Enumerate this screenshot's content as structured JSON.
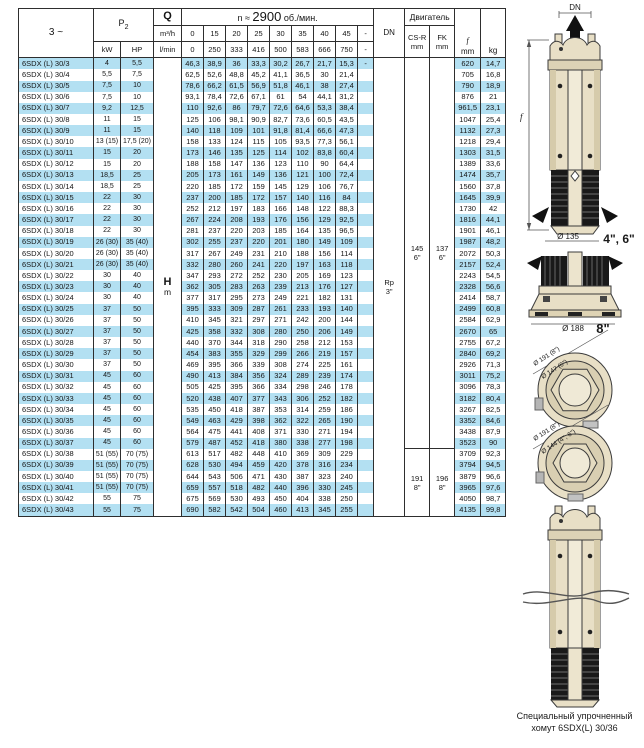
{
  "page": {
    "caption_line1": "Специальный упрочненный",
    "caption_line2": "хомут 6SDX(L) 30/36"
  },
  "table": {
    "header": {
      "phase": "3 ~",
      "p2_main": "P",
      "p2_sub": "2",
      "kw": "kW",
      "hp": "HP",
      "q": "Q",
      "q_unit_top": "m³/h",
      "q_unit_bottom": "l/min",
      "speed_prefix": "n ≈ ",
      "speed_value": "2900",
      "speed_suffix": " об./мин.",
      "flow_m3h": [
        "0",
        "15",
        "20",
        "25",
        "30",
        "35",
        "40",
        "45",
        "-"
      ],
      "flow_lmin": [
        "0",
        "250",
        "333",
        "416",
        "500",
        "583",
        "666",
        "750",
        "-"
      ],
      "dn": "DN",
      "motor": "Двигатель",
      "csr": [
        "CS-R",
        "mm"
      ],
      "fk": [
        "FK",
        "mm"
      ],
      "f": [
        "f",
        "mm"
      ],
      "kg": "kg"
    },
    "merged": {
      "h_label": "H",
      "m_label": "m",
      "dn": [
        "Rp",
        "3\""
      ],
      "csr_small": [
        "145",
        "6\""
      ],
      "fk_small": [
        "137",
        "6\""
      ],
      "small_span": 35,
      "csr_large": [
        "191",
        "8\""
      ],
      "fk_large": [
        "196",
        "8\""
      ],
      "large_span": 6
    },
    "rows": [
      {
        "m": "6SDX (L) 30/3",
        "kw": "4",
        "hp": "5,5",
        "h": [
          "46,3",
          "38,9",
          "36",
          "33,3",
          "30,2",
          "26,7",
          "21,7",
          "15,3"
        ],
        "dash": "-",
        "f": "620",
        "kg": "14,7"
      },
      {
        "m": "6SDX (L) 30/4",
        "kw": "5,5",
        "hp": "7,5",
        "h": [
          "62,5",
          "52,6",
          "48,8",
          "45,2",
          "41,1",
          "36,5",
          "30",
          "21,4"
        ],
        "dash": "",
        "f": "705",
        "kg": "16,8"
      },
      {
        "m": "6SDX (L) 30/5",
        "kw": "7,5",
        "hp": "10",
        "h": [
          "78,6",
          "66,2",
          "61,5",
          "56,9",
          "51,8",
          "46,1",
          "38",
          "27,4"
        ],
        "dash": "",
        "f": "790",
        "kg": "18,9"
      },
      {
        "m": "6SDX (L) 30/6",
        "kw": "7,5",
        "hp": "10",
        "h": [
          "93,1",
          "78,4",
          "72,6",
          "67,1",
          "61",
          "54",
          "44,1",
          "31,2"
        ],
        "dash": "",
        "f": "876",
        "kg": "21"
      },
      {
        "m": "6SDX (L) 30/7",
        "kw": "9,2",
        "hp": "12,5",
        "h": [
          "110",
          "92,6",
          "86",
          "79,7",
          "72,6",
          "64,6",
          "53,3",
          "38,4"
        ],
        "dash": "",
        "f": "961,5",
        "kg": "23,1"
      },
      {
        "m": "6SDX (L) 30/8",
        "kw": "11",
        "hp": "15",
        "h": [
          "125",
          "106",
          "98,1",
          "90,9",
          "82,7",
          "73,6",
          "60,5",
          "43,5"
        ],
        "dash": "",
        "f": "1047",
        "kg": "25,4"
      },
      {
        "m": "6SDX (L) 30/9",
        "kw": "11",
        "hp": "15",
        "h": [
          "140",
          "118",
          "109",
          "101",
          "91,8",
          "81,4",
          "66,6",
          "47,3"
        ],
        "dash": "",
        "f": "1132",
        "kg": "27,3"
      },
      {
        "m": "6SDX (L) 30/10",
        "kw": "13 (15)",
        "hp": "17,5 (20)",
        "h": [
          "158",
          "133",
          "124",
          "115",
          "105",
          "93,5",
          "77,3",
          "56,1"
        ],
        "dash": "",
        "f": "1218",
        "kg": "29,4"
      },
      {
        "m": "6SDX (L) 30/11",
        "kw": "15",
        "hp": "20",
        "h": [
          "173",
          "146",
          "135",
          "125",
          "114",
          "102",
          "83,8",
          "60,4"
        ],
        "dash": "",
        "f": "1303",
        "kg": "31,5"
      },
      {
        "m": "6SDX (L) 30/12",
        "kw": "15",
        "hp": "20",
        "h": [
          "188",
          "158",
          "147",
          "136",
          "123",
          "110",
          "90",
          "64,4"
        ],
        "dash": "",
        "f": "1389",
        "kg": "33,6"
      },
      {
        "m": "6SDX (L) 30/13",
        "kw": "18,5",
        "hp": "25",
        "h": [
          "205",
          "173",
          "161",
          "149",
          "136",
          "121",
          "100",
          "72,4"
        ],
        "dash": "",
        "f": "1474",
        "kg": "35,7"
      },
      {
        "m": "6SDX (L) 30/14",
        "kw": "18,5",
        "hp": "25",
        "h": [
          "220",
          "185",
          "172",
          "159",
          "145",
          "129",
          "106",
          "76,7"
        ],
        "dash": "",
        "f": "1560",
        "kg": "37,8"
      },
      {
        "m": "6SDX (L) 30/15",
        "kw": "22",
        "hp": "30",
        "h": [
          "237",
          "200",
          "185",
          "172",
          "157",
          "140",
          "116",
          "84"
        ],
        "dash": "",
        "f": "1645",
        "kg": "39,9"
      },
      {
        "m": "6SDX (L) 30/16",
        "kw": "22",
        "hp": "30",
        "h": [
          "252",
          "212",
          "197",
          "183",
          "166",
          "148",
          "122",
          "88,3"
        ],
        "dash": "",
        "f": "1730",
        "kg": "42"
      },
      {
        "m": "6SDX (L) 30/17",
        "kw": "22",
        "hp": "30",
        "h": [
          "267",
          "224",
          "208",
          "193",
          "176",
          "156",
          "129",
          "92,5"
        ],
        "dash": "",
        "f": "1816",
        "kg": "44,1"
      },
      {
        "m": "6SDX (L) 30/18",
        "kw": "22",
        "hp": "30",
        "h": [
          "281",
          "237",
          "220",
          "203",
          "185",
          "164",
          "135",
          "96,5"
        ],
        "dash": "",
        "f": "1901",
        "kg": "46,1"
      },
      {
        "m": "6SDX (L) 30/19",
        "kw": "26 (30)",
        "hp": "35 (40)",
        "h": [
          "302",
          "255",
          "237",
          "220",
          "201",
          "180",
          "149",
          "109"
        ],
        "dash": "",
        "f": "1987",
        "kg": "48,2"
      },
      {
        "m": "6SDX (L) 30/20",
        "kw": "26 (30)",
        "hp": "35 (40)",
        "h": [
          "317",
          "267",
          "249",
          "231",
          "210",
          "188",
          "156",
          "114"
        ],
        "dash": "",
        "f": "2072",
        "kg": "50,3"
      },
      {
        "m": "6SDX (L) 30/21",
        "kw": "26 (30)",
        "hp": "35 (40)",
        "h": [
          "332",
          "280",
          "260",
          "241",
          "220",
          "197",
          "163",
          "118"
        ],
        "dash": "",
        "f": "2157",
        "kg": "52,4"
      },
      {
        "m": "6SDX (L) 30/22",
        "kw": "30",
        "hp": "40",
        "h": [
          "347",
          "293",
          "272",
          "252",
          "230",
          "205",
          "169",
          "123"
        ],
        "dash": "",
        "f": "2243",
        "kg": "54,5"
      },
      {
        "m": "6SDX (L) 30/23",
        "kw": "30",
        "hp": "40",
        "h": [
          "362",
          "305",
          "283",
          "263",
          "239",
          "213",
          "176",
          "127"
        ],
        "dash": "",
        "f": "2328",
        "kg": "56,6"
      },
      {
        "m": "6SDX (L) 30/24",
        "kw": "30",
        "hp": "40",
        "h": [
          "377",
          "317",
          "295",
          "273",
          "249",
          "221",
          "182",
          "131"
        ],
        "dash": "",
        "f": "2414",
        "kg": "58,7"
      },
      {
        "m": "6SDX (L) 30/25",
        "kw": "37",
        "hp": "50",
        "h": [
          "395",
          "333",
          "309",
          "287",
          "261",
          "233",
          "193",
          "140"
        ],
        "dash": "",
        "f": "2499",
        "kg": "60,8"
      },
      {
        "m": "6SDX (L) 30/26",
        "kw": "37",
        "hp": "50",
        "h": [
          "410",
          "345",
          "321",
          "297",
          "271",
          "242",
          "200",
          "144"
        ],
        "dash": "",
        "f": "2584",
        "kg": "62,9"
      },
      {
        "m": "6SDX (L) 30/27",
        "kw": "37",
        "hp": "50",
        "h": [
          "425",
          "358",
          "332",
          "308",
          "280",
          "250",
          "206",
          "149"
        ],
        "dash": "",
        "f": "2670",
        "kg": "65"
      },
      {
        "m": "6SDX (L) 30/28",
        "kw": "37",
        "hp": "50",
        "h": [
          "440",
          "370",
          "344",
          "318",
          "290",
          "258",
          "212",
          "153"
        ],
        "dash": "",
        "f": "2755",
        "kg": "67,2"
      },
      {
        "m": "6SDX (L) 30/29",
        "kw": "37",
        "hp": "50",
        "h": [
          "454",
          "383",
          "355",
          "329",
          "299",
          "266",
          "219",
          "157"
        ],
        "dash": "",
        "f": "2840",
        "kg": "69,2"
      },
      {
        "m": "6SDX (L) 30/30",
        "kw": "37",
        "hp": "50",
        "h": [
          "469",
          "395",
          "366",
          "339",
          "308",
          "274",
          "225",
          "161"
        ],
        "dash": "",
        "f": "2926",
        "kg": "71,3"
      },
      {
        "m": "6SDX (L) 30/31",
        "kw": "45",
        "hp": "60",
        "h": [
          "490",
          "413",
          "384",
          "356",
          "324",
          "289",
          "239",
          "174"
        ],
        "dash": "",
        "f": "3011",
        "kg": "75,2"
      },
      {
        "m": "6SDX (L) 30/32",
        "kw": "45",
        "hp": "60",
        "h": [
          "505",
          "425",
          "395",
          "366",
          "334",
          "298",
          "246",
          "178"
        ],
        "dash": "",
        "f": "3096",
        "kg": "78,3"
      },
      {
        "m": "6SDX (L) 30/33",
        "kw": "45",
        "hp": "60",
        "h": [
          "520",
          "438",
          "407",
          "377",
          "343",
          "306",
          "252",
          "182"
        ],
        "dash": "",
        "f": "3182",
        "kg": "80,4"
      },
      {
        "m": "6SDX (L) 30/34",
        "kw": "45",
        "hp": "60",
        "h": [
          "535",
          "450",
          "418",
          "387",
          "353",
          "314",
          "259",
          "186"
        ],
        "dash": "",
        "f": "3267",
        "kg": "82,5"
      },
      {
        "m": "6SDX (L) 30/35",
        "kw": "45",
        "hp": "60",
        "h": [
          "549",
          "463",
          "429",
          "398",
          "362",
          "322",
          "265",
          "190"
        ],
        "dash": "",
        "f": "3352",
        "kg": "84,6"
      },
      {
        "m": "6SDX (L) 30/36",
        "kw": "45",
        "hp": "60",
        "h": [
          "564",
          "475",
          "441",
          "408",
          "371",
          "330",
          "271",
          "194"
        ],
        "dash": "",
        "f": "3438",
        "kg": "87,9"
      },
      {
        "m": "6SDX (L) 30/37",
        "kw": "45",
        "hp": "60",
        "h": [
          "579",
          "487",
          "452",
          "418",
          "380",
          "338",
          "277",
          "198"
        ],
        "dash": "",
        "f": "3523",
        "kg": "90"
      },
      {
        "m": "6SDX (L) 30/38",
        "kw": "51 (55)",
        "hp": "70 (75)",
        "h": [
          "613",
          "517",
          "482",
          "448",
          "410",
          "369",
          "309",
          "229"
        ],
        "dash": "",
        "f": "3709",
        "kg": "92,3"
      },
      {
        "m": "6SDX (L) 30/39",
        "kw": "51 (55)",
        "hp": "70 (75)",
        "h": [
          "628",
          "530",
          "494",
          "459",
          "420",
          "378",
          "316",
          "234"
        ],
        "dash": "",
        "f": "3794",
        "kg": "94,5"
      },
      {
        "m": "6SDX (L) 30/40",
        "kw": "51 (55)",
        "hp": "70 (75)",
        "h": [
          "644",
          "543",
          "506",
          "471",
          "430",
          "387",
          "323",
          "240"
        ],
        "dash": "",
        "f": "3879",
        "kg": "96,6"
      },
      {
        "m": "6SDX (L) 30/41",
        "kw": "51 (55)",
        "hp": "70 (75)",
        "h": [
          "659",
          "557",
          "518",
          "482",
          "440",
          "396",
          "330",
          "245"
        ],
        "dash": "",
        "f": "3965",
        "kg": "97,6"
      },
      {
        "m": "6SDX (L) 30/42",
        "kw": "55",
        "hp": "75",
        "h": [
          "675",
          "569",
          "530",
          "493",
          "450",
          "404",
          "338",
          "250"
        ],
        "dash": "",
        "f": "4050",
        "kg": "98,7"
      },
      {
        "m": "6SDX (L) 30/43",
        "kw": "55",
        "hp": "75",
        "h": [
          "690",
          "582",
          "542",
          "504",
          "460",
          "413",
          "345",
          "255"
        ],
        "dash": "",
        "f": "4135",
        "kg": "99,8"
      }
    ]
  },
  "drawings": {
    "dn": "DN",
    "f": "f",
    "d135": "Ø 135",
    "size_46": "4\", 6\"",
    "d188": "Ø 188",
    "size_8": "8\"",
    "circle1_outer": "Ø 191 (8\")",
    "circle1_inner": "Ø 147 (6\")",
    "circle2_outer": "Ø 191 (8\")",
    "circle2_inner": "Ø 144 (4\", 6\")"
  },
  "colors": {
    "stripe": "#b3e0f2",
    "border": "#2e2e2e",
    "pump_body": "#e8dfc6",
    "pump_dark": "#191919"
  }
}
